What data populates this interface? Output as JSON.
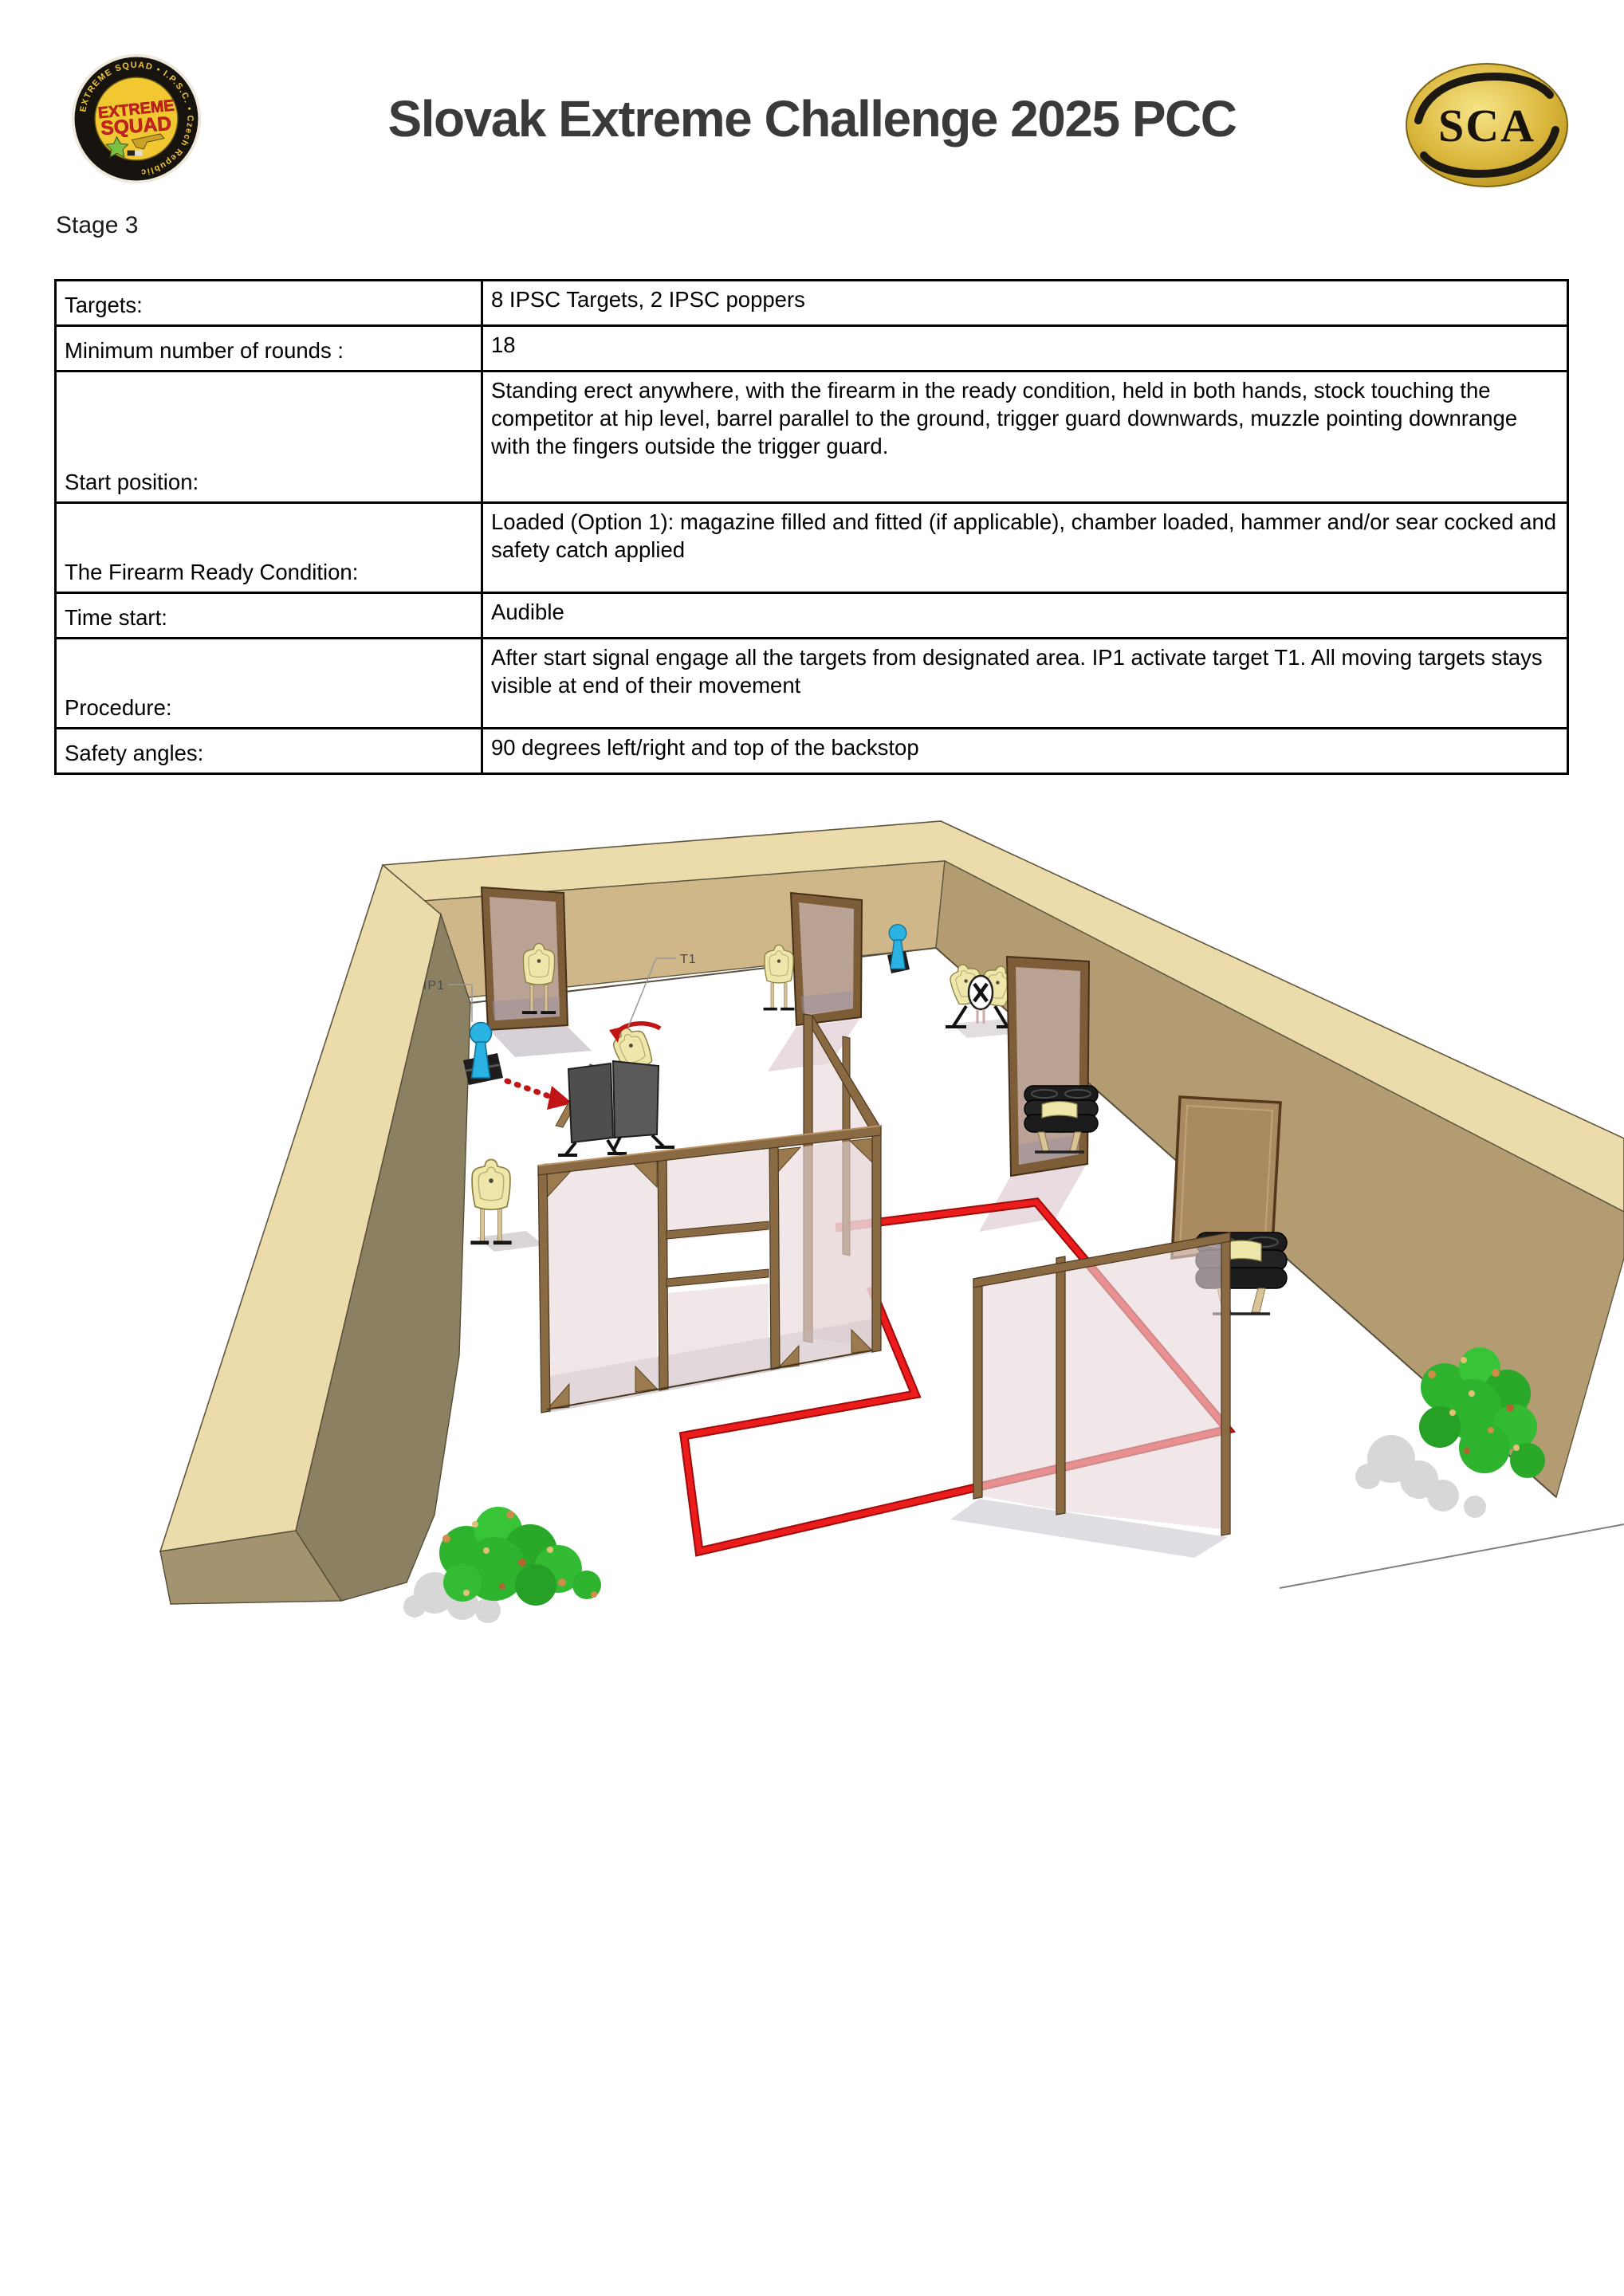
{
  "header": {
    "title": "Slovak Extreme Challenge 2025 PCC",
    "badge": {
      "ring_text": "EXTREME SQUAD • I.P.S.C. • Czech Republic",
      "line1": "EXTREME",
      "line2": "SQUAD"
    },
    "sca": {
      "text": "SCA"
    }
  },
  "stage_label": "Stage 3",
  "briefing_table": {
    "rows": [
      {
        "label": "Targets:",
        "value": "8 IPSC Targets, 2 IPSC poppers"
      },
      {
        "label": "Minimum number of rounds :",
        "value": "18"
      },
      {
        "label": "Start position:",
        "value": "Standing erect anywhere, with the firearm in the ready condition, held in both hands, stock touching the competitor at hip level, barrel parallel to the ground, trigger guard downwards, muzzle pointing downrange with the fingers outside the trigger guard."
      },
      {
        "label": "The Firearm Ready Condition:",
        "value": "Loaded (Option 1): magazine filled and fitted (if applicable), chamber loaded, hammer and/or sear cocked and safety catch applied"
      },
      {
        "label": "Time start:",
        "value": "Audible"
      },
      {
        "label": "Procedure:",
        "value": "After start signal engage all the targets from designated area. IP1 activate target T1. All moving targets stays visible at end of their movement"
      },
      {
        "label": "Safety angles:",
        "value": "90 degrees left/right and top of the backstop"
      }
    ]
  },
  "diagram": {
    "labels": {
      "ip1": "IP1",
      "t1": "T1"
    },
    "colors": {
      "fault_line": "#e01212",
      "popper_blue": "#2ab2e3",
      "target_cream": "#efe6ab",
      "wall_top": "#ecdcab",
      "wall_back_face": "#cfb78a",
      "wall_right_face": "#b39b72",
      "wall_left_face": "#8c8062",
      "mesh_pink": "#e9d8da",
      "wood": "#8a6a43"
    }
  }
}
